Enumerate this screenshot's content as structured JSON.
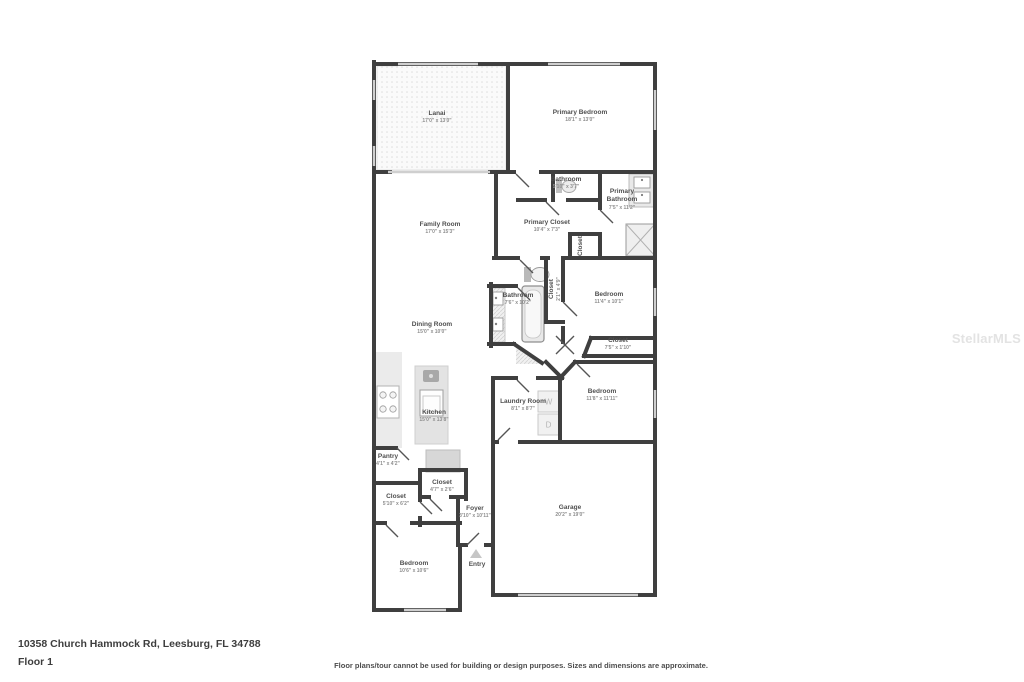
{
  "watermark": "StellarMLS",
  "footer": {
    "address": "10358 Church Hammock Rd, Leesburg, FL 34788",
    "floor": "Floor 1",
    "disclaimer": "Floor plans/tour cannot be used for building or design purposes. Sizes and dimensions are approximate."
  },
  "colors": {
    "wall": "#3f3f3f",
    "window": "#cfcfcf",
    "fixture_fill": "#ececec",
    "fixture_stroke": "#9a9a9a",
    "label": "#4f4f4f",
    "dim_label": "#8e8e8e"
  },
  "laundry": {
    "washer_label": "W",
    "dryer_label": "D"
  },
  "rooms": [
    {
      "id": "lanai",
      "name": "Lanai",
      "dims": "17'0\" x 13'0\""
    },
    {
      "id": "primary-bedroom",
      "name": "Primary Bedroom",
      "dims": "18'1\" x 13'0\""
    },
    {
      "id": "bathroom-top",
      "name": "Bathroom",
      "dims": "5'10\" x 3'7\""
    },
    {
      "id": "primary-bathroom",
      "name": "Primary Bathroom",
      "dims": "7'5\" x 11'2\""
    },
    {
      "id": "primary-closet",
      "name": "Primary Closet",
      "dims": "10'4\" x 7'3\""
    },
    {
      "id": "family-room",
      "name": "Family Room",
      "dims": "17'0\" x 15'3\""
    },
    {
      "id": "closet-primary",
      "name": "Closet",
      "dims": ""
    },
    {
      "id": "closet-hall",
      "name": "Closet",
      "dims": "2'1\" x 4'9\""
    },
    {
      "id": "bathroom-main",
      "name": "Bathroom",
      "dims": "7'6\" x 10'2\""
    },
    {
      "id": "bedroom-1",
      "name": "Bedroom",
      "dims": "11'4\" x 10'1\""
    },
    {
      "id": "dining-room",
      "name": "Dining Room",
      "dims": "15'0\" x 10'0\""
    },
    {
      "id": "closet-bedroom1",
      "name": "Closet",
      "dims": "7'5\" x 1'10\""
    },
    {
      "id": "bedroom-2",
      "name": "Bedroom",
      "dims": "11'8\" x 11'11\""
    },
    {
      "id": "laundry-room",
      "name": "Laundry Room",
      "dims": "8'1\" x 8'7\""
    },
    {
      "id": "kitchen",
      "name": "Kitchen",
      "dims": "15'0\" x 13'8\""
    },
    {
      "id": "pantry",
      "name": "Pantry",
      "dims": "4'1\" x 4'2\""
    },
    {
      "id": "closet-interior",
      "name": "Closet",
      "dims": "4'7\" x 2'6\""
    },
    {
      "id": "closet-hall2",
      "name": "Closet",
      "dims": "5'10\" x 6'2\""
    },
    {
      "id": "foyer",
      "name": "Foyer",
      "dims": "3'10\" x 10'11\""
    },
    {
      "id": "garage",
      "name": "Garage",
      "dims": "20'2\" x 19'0\""
    },
    {
      "id": "bedroom-3",
      "name": "Bedroom",
      "dims": "10'6\" x 10'6\""
    },
    {
      "id": "entry",
      "name": "Entry",
      "dims": ""
    }
  ]
}
